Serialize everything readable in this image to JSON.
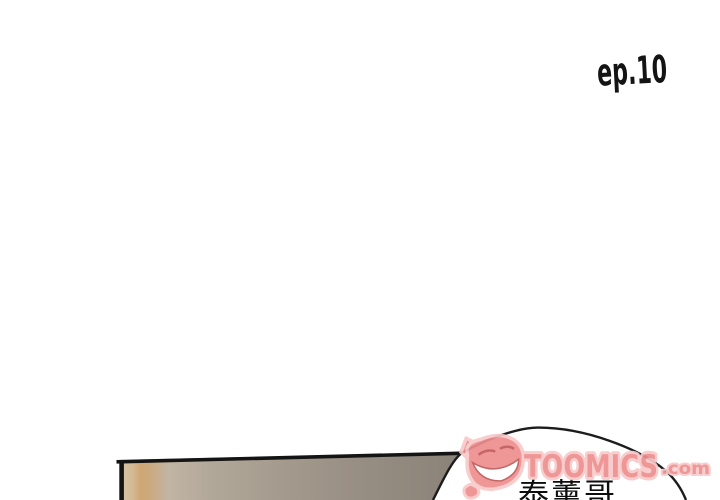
{
  "page": {
    "episode_label": "ep.10",
    "ink_color": "#141414",
    "background_color": "#ffffff"
  },
  "panel": {
    "border_color": "#141414",
    "gradient_stops": [
      "#d5c2a6",
      "#d4bb95",
      "#d0a674",
      "#cbaa80",
      "#c1b5a4",
      "#b2a89a",
      "#a2988b",
      "#938a80",
      "#8a8278"
    ]
  },
  "speech_bubble": {
    "text": "泰薰哥",
    "text_color": "#0d0d0d",
    "fill": "#ffffff",
    "outline_color": "#1c1c1c"
  },
  "watermark": {
    "icon": "toomics-devil-grin",
    "brand": "TOOMICS",
    "tld": ".com",
    "fill_color": "#ee8e8e",
    "outline_color": "#f8c9c9",
    "grin_color": "#ffffff",
    "detail_color": "#c25858"
  }
}
